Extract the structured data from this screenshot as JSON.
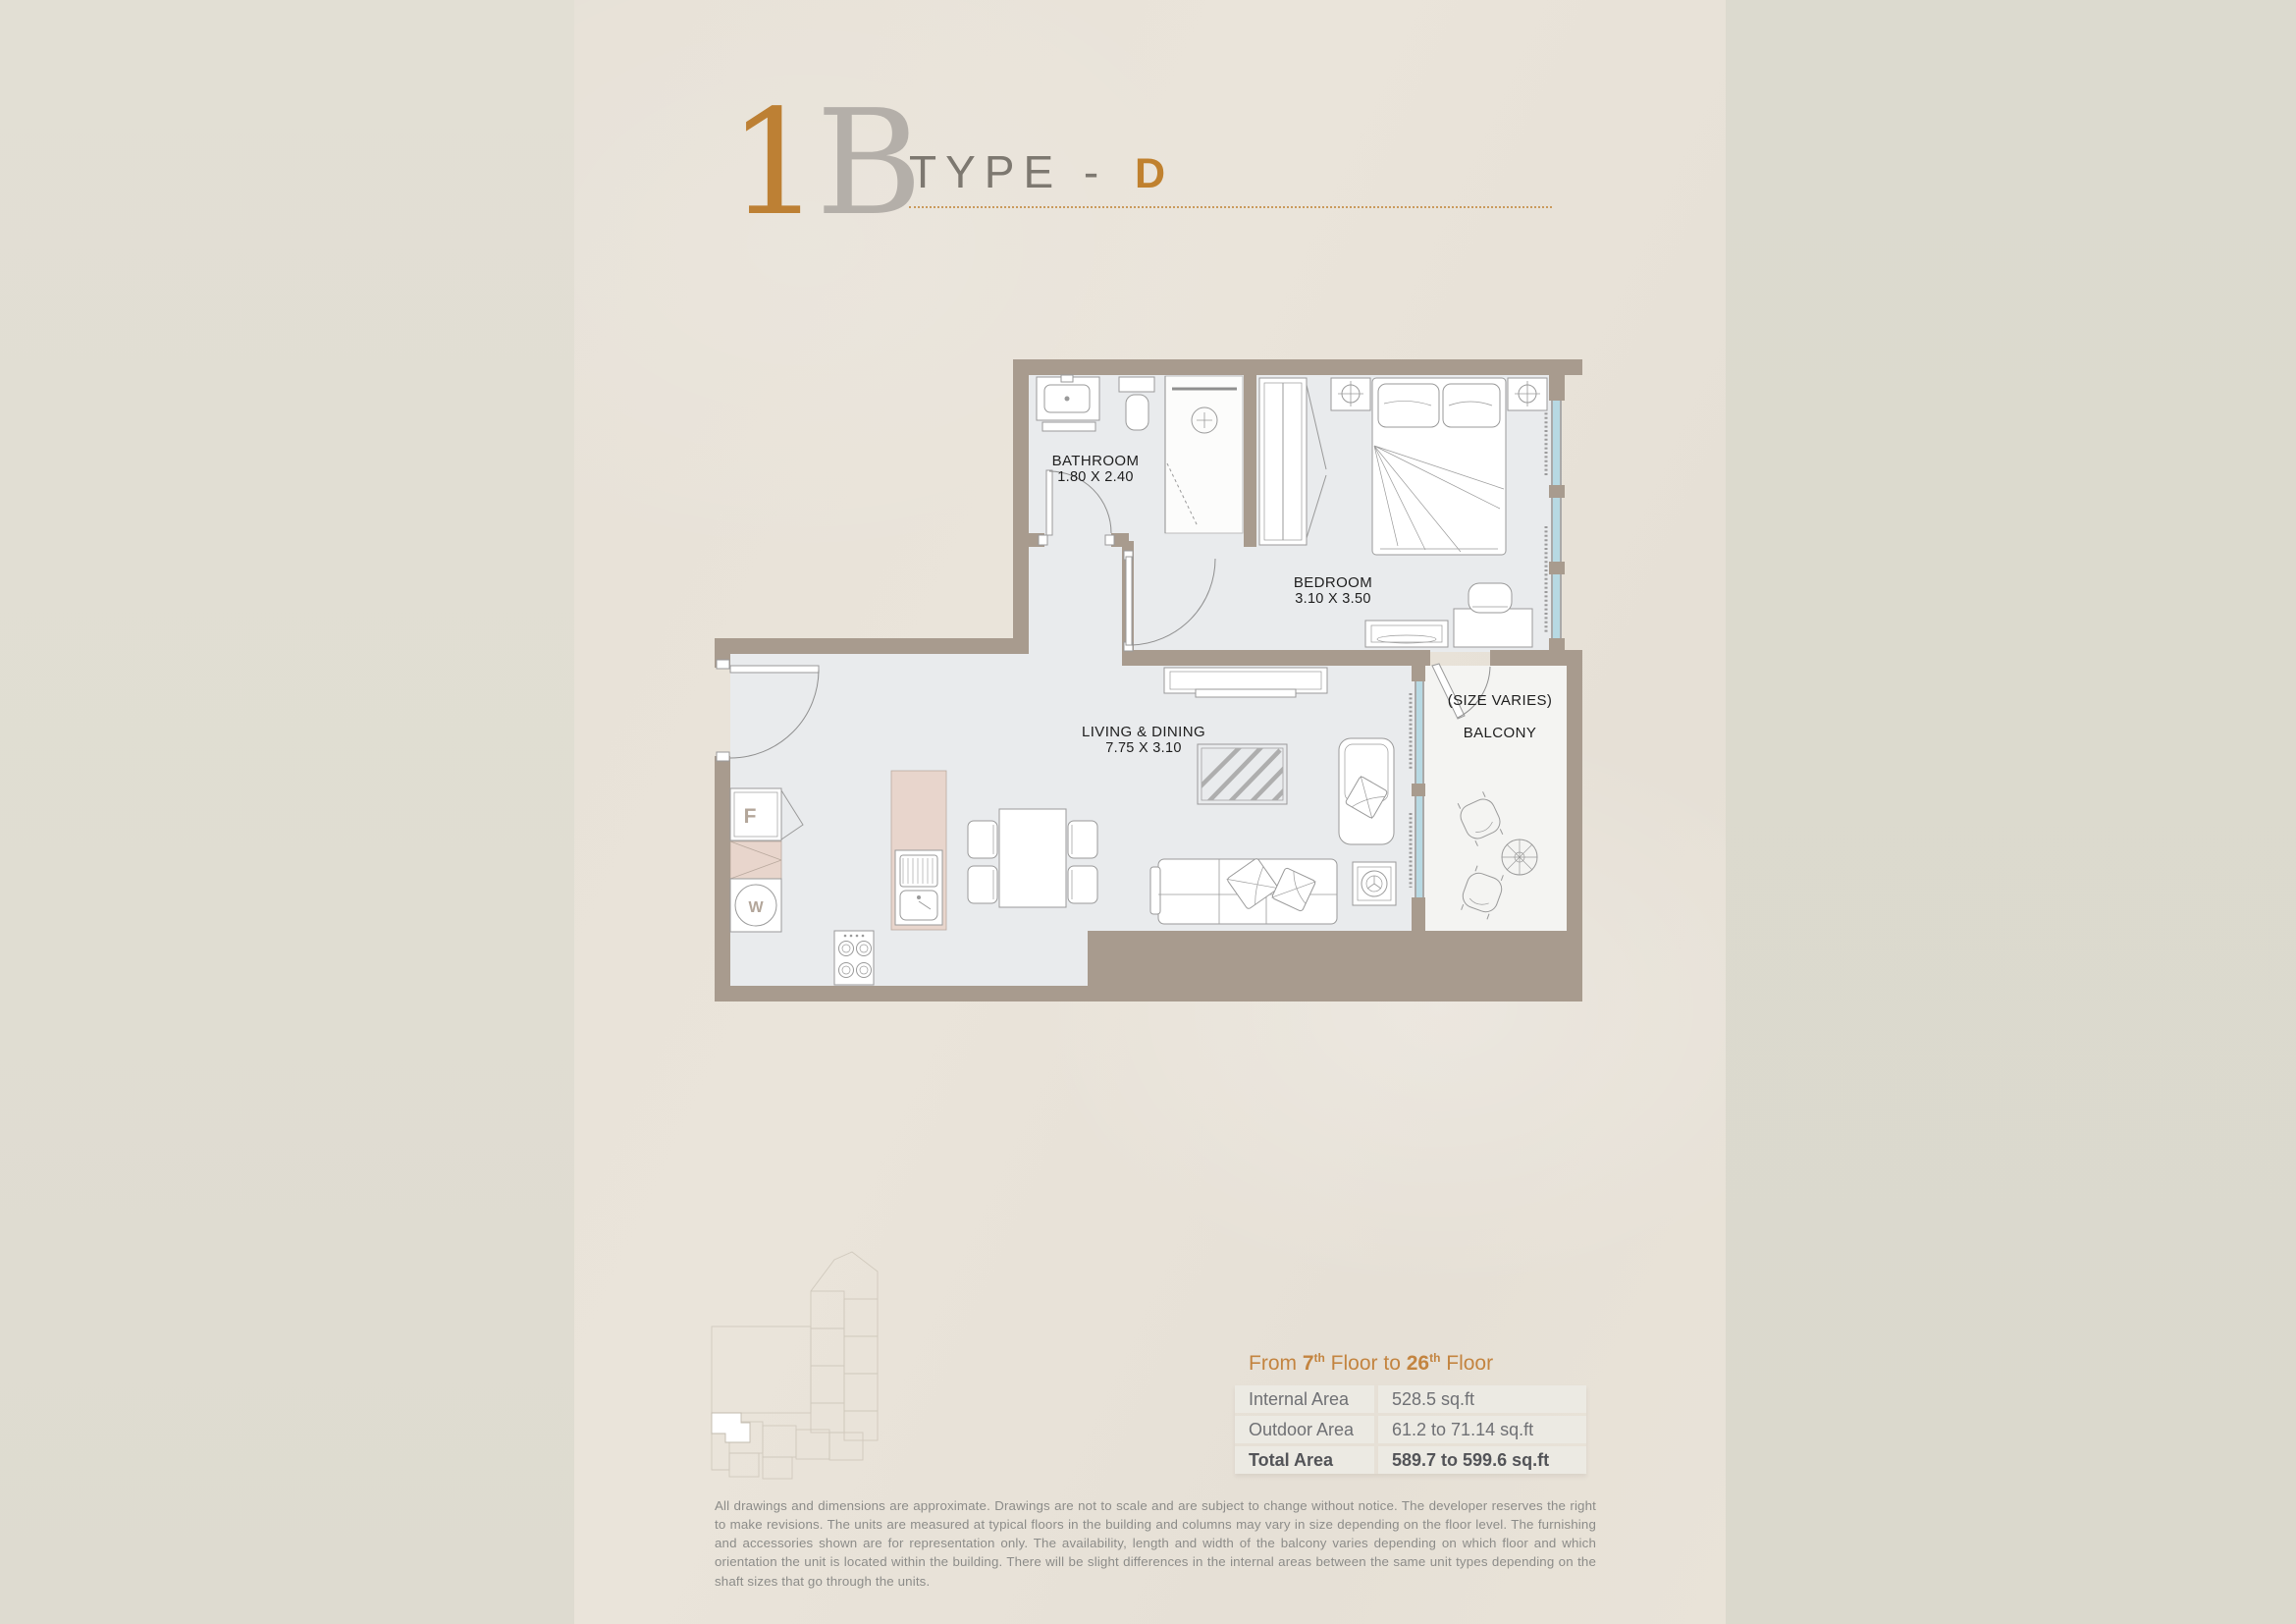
{
  "title": {
    "unit": "1",
    "letter": "B",
    "type_label": "TYPE - ",
    "type_value": "D"
  },
  "floor_plan": {
    "rooms": {
      "bathroom": {
        "name": "BATHROOM",
        "dims": "1.80 X 2.40"
      },
      "bedroom": {
        "name": "BEDROOM",
        "dims": "3.10 X 3.50"
      },
      "living": {
        "name": "LIVING & DINING",
        "dims": "7.75 X 3.10"
      },
      "balcony": {
        "note": "(SIZE VARIES)",
        "name": "BALCONY"
      }
    },
    "appliances": {
      "fridge_label": "F",
      "washer_label": "W"
    }
  },
  "area_info": {
    "floors_line": {
      "prefix": "From ",
      "start_floor": "7",
      "start_sup": "th",
      "mid": " Floor to ",
      "end_floor": "26",
      "end_sup": "th",
      "suffix": " Floor"
    },
    "rows": [
      {
        "label": "Internal Area",
        "value": "528.5 sq.ft"
      },
      {
        "label": "Outdoor Area",
        "value": "61.2 to 71.14 sq.ft"
      },
      {
        "label": "Total Area",
        "value": "589.7 to 599.6 sq.ft"
      }
    ]
  },
  "disclaimer": "All drawings and dimensions are approximate. Drawings are not to scale and are subject to change without notice. The developer reserves the right to make revisions. The units are measured at typical floors in the building and columns may vary in size depending on the floor level. The furnishing and accessories shown are for representation only. The availability, length and width of the balcony varies depending on which floor and which orientation the unit is located within the building. There will be slight differences in the internal areas between the same unit types depending on the shaft sizes that go through the units.",
  "colors": {
    "accent_orange": "#bd8034",
    "title_gray": "#b4afa9",
    "wall": "#a89b8e",
    "floor": "#e9ebed",
    "balcony_floor": "#f4f4f2",
    "counter_pink": "#e8d5cc",
    "glazing_blue": "#b7d9e3",
    "table_text": "#6f7074",
    "disclaimer_text": "#8c8c89"
  }
}
